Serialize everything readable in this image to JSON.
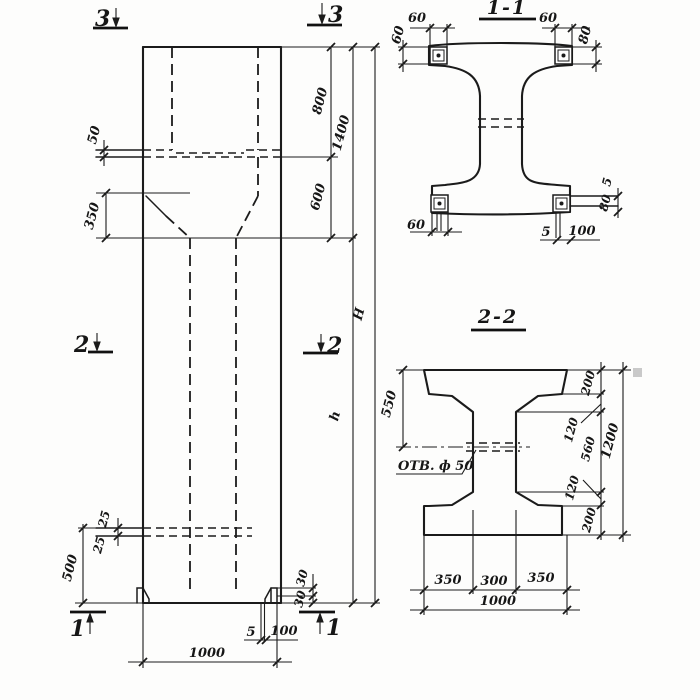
{
  "elevation": {
    "markers": {
      "top_left": "3",
      "top_right": "3",
      "mid_left": "2",
      "mid_right": "2",
      "bot_left": "1",
      "bot_right": "1"
    },
    "dims": {
      "step": "50",
      "taper": "350",
      "tie_a": "25",
      "tie_b": "25",
      "base": "500",
      "seg_top": "800",
      "upper_total": "1400",
      "seg_neck": "600",
      "height_total": "H",
      "height_shaft": "h",
      "foot_a": "30",
      "foot_b": "30",
      "anchor_w": "5",
      "anchor_len": "100",
      "width": "1000"
    }
  },
  "section1": {
    "title": "1-1",
    "dims": {
      "tl_w": "60",
      "l_h": "60",
      "tr_w": "60",
      "r_h": "80",
      "bl_w": "60",
      "br_t": "5",
      "br_len": "100",
      "lug_t": "5",
      "lug_h": "80"
    }
  },
  "section2": {
    "title": "2-2",
    "hole_label": "ОТВ. ф 50",
    "dims": {
      "top_to_hole": "550",
      "flange_top": "200",
      "taper_top": "120",
      "web": "560",
      "taper_bot": "120",
      "flange_bot": "200",
      "total": "1200",
      "bot_left": "350",
      "bot_mid": "300",
      "bot_right": "350",
      "bot_total": "1000"
    }
  }
}
